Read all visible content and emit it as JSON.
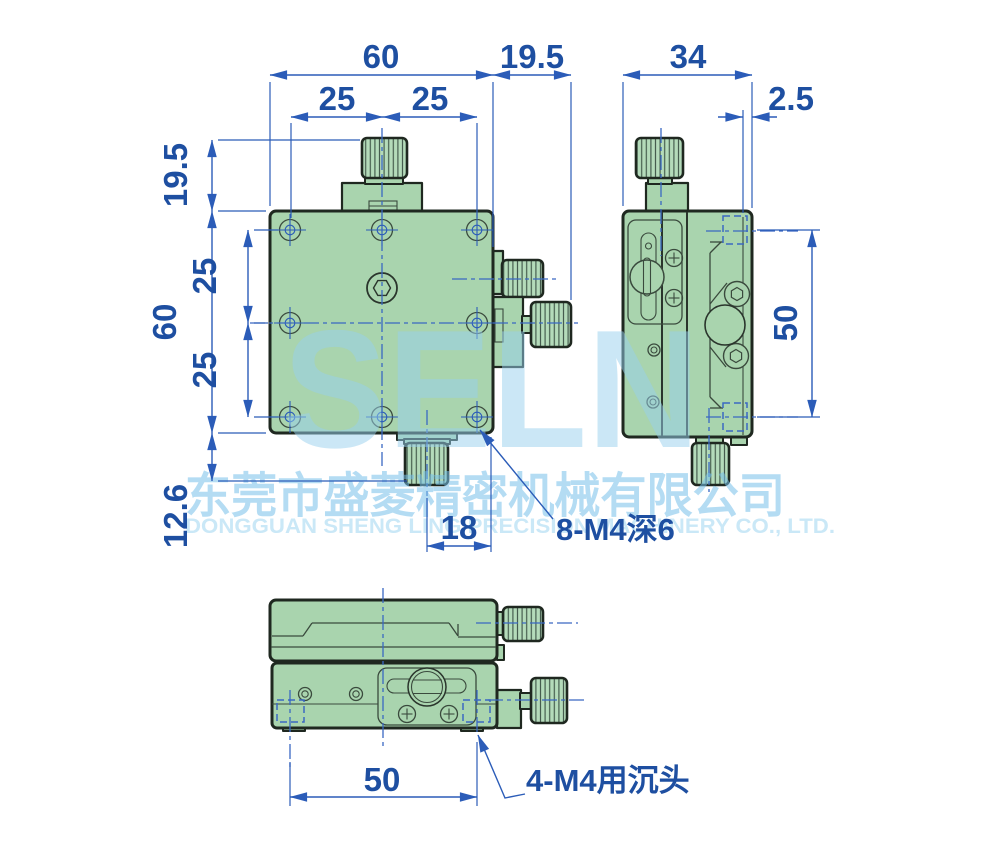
{
  "watermark": {
    "logo": "SELN",
    "company_cn": "东莞市盛菱精密机械有限公司",
    "company_en": "DONGGUAN SHENG LING PRECISION MACHINERY CO., LTD."
  },
  "dimensions": {
    "front": {
      "overall_width": "60",
      "knob_right_offset": "19.5",
      "hole_pitch_top_left": "25",
      "hole_pitch_top_right": "25",
      "knob_top_height": "19.5",
      "overall_height": "60",
      "hole_pitch_left_upper": "25",
      "hole_pitch_left_lower": "25",
      "bottom_knob_height": "12.6",
      "bottom_knob_offset": "18"
    },
    "side": {
      "overall_width": "34",
      "plate_offset": "2.5",
      "hole_pitch": "50"
    },
    "bottom": {
      "hole_pitch": "50"
    }
  },
  "labels": {
    "tapped_holes": "8-M4深6",
    "counterbore_holes": "4-M4用沉头"
  },
  "colors": {
    "body_green": "#a9d4ae",
    "outline_dark": "#1f2820",
    "dimension_blue": "#1e4fa1",
    "centerline_blue": "#3a68c2",
    "watermark_blue": "#bfe3f4"
  }
}
